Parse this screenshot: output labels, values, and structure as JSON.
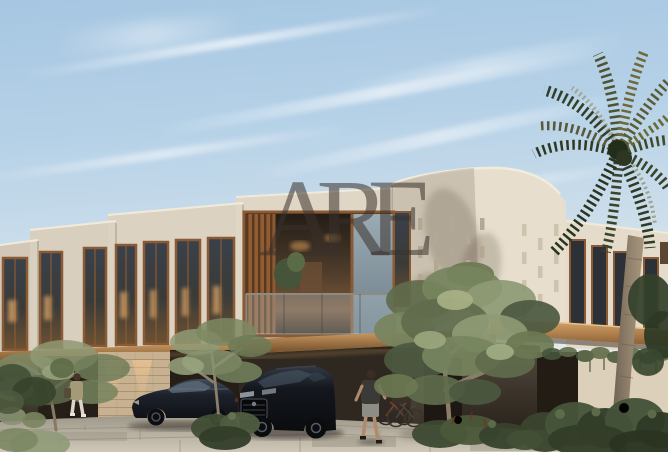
{
  "image": {
    "kind": "real-estate architectural rendering photo",
    "subject": "modern two-storey townhouse row at golden hour"
  },
  "watermark": {
    "text": "ARE"
  },
  "palette": {
    "sky_top": "#a6c6e1",
    "sky_horizon": "#efeee7",
    "facade_sunlit": "#e7decd",
    "facade_shaded": "#d3c8b7",
    "wood_frame": "#8a5a34",
    "canopy_wood_lit": "#dcab70",
    "glass_dark": "#39414b",
    "interior_glow": "#d79b58",
    "stone_accent_wall": "#c7b190",
    "ground_floor_bronze": "#3f382f",
    "driveway_paver": "#c6bfb0",
    "olive_foliage": "#76845e",
    "palm_dark_green": "#33402a",
    "palm_gold": "#8a7b45",
    "car_black": "#14171d"
  },
  "scene": {
    "elements": [
      "blue sky with wispy diagonal clouds",
      "stepped row of cream stucco townhouses receding left",
      "rounded-corner block with perforated facade pattern",
      "balcony with wood louvers, glass balustrade and plant",
      "tall wood-framed windows with warm interior light",
      "wood canopy band between floors",
      "stone accent wall with uplights at garage level",
      "dark bronze ground-floor garage walls",
      "dark sedan and black SUV parked on driveway",
      "pedestrian carrying bag near garages",
      "jogger walking past parked SUV",
      "two bicycles leaning on wall",
      "three olive trees and low shrubs",
      "tall palm tree on the right with curved trunk",
      "green hedge across bottom right",
      "large-format paver driveway in foreground",
      "ARE watermark over the center"
    ]
  }
}
